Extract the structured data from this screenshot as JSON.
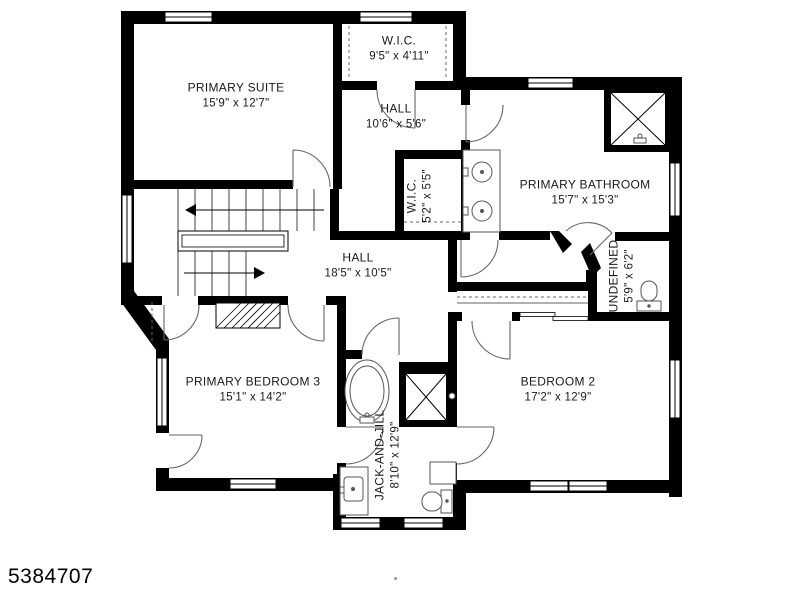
{
  "watermark": {
    "id": "5384707"
  },
  "rooms": [
    {
      "name": "PRIMARY SUITE",
      "dims": "15'9\" x 12'7\""
    },
    {
      "name": "W.I.C.",
      "dims": "9'5\" x 4'11\""
    },
    {
      "name": "HALL",
      "dims": "10'6\" x 5'6\""
    },
    {
      "name": "PRIMARY BATHROOM",
      "dims": "15'7\" x 15'3\""
    },
    {
      "name": "W.I.C.",
      "dims": "5'2\" x 5'5\""
    },
    {
      "name": "HALL",
      "dims": "18'5\" x 10'5\""
    },
    {
      "name": "UNDEFINED",
      "dims": "5'9\" x 6'2\""
    },
    {
      "name": "PRIMARY BEDROOM 3",
      "dims": "15'1\" x 14'2\""
    },
    {
      "name": "JACK-AND-JILL",
      "dims": "8'10\" x 12'9\""
    },
    {
      "name": "BEDROOM 2",
      "dims": "17'2\" x 12'9\""
    }
  ],
  "fixtures": [
    "shower",
    "shower",
    "bathtub",
    "double-sink-vanity",
    "sink-vanity",
    "toilet",
    "toilet",
    "staircase"
  ],
  "colors": {
    "wall": "#000000",
    "floor": "#ffffff",
    "line": "#666666",
    "text": "#1a1a1a"
  }
}
